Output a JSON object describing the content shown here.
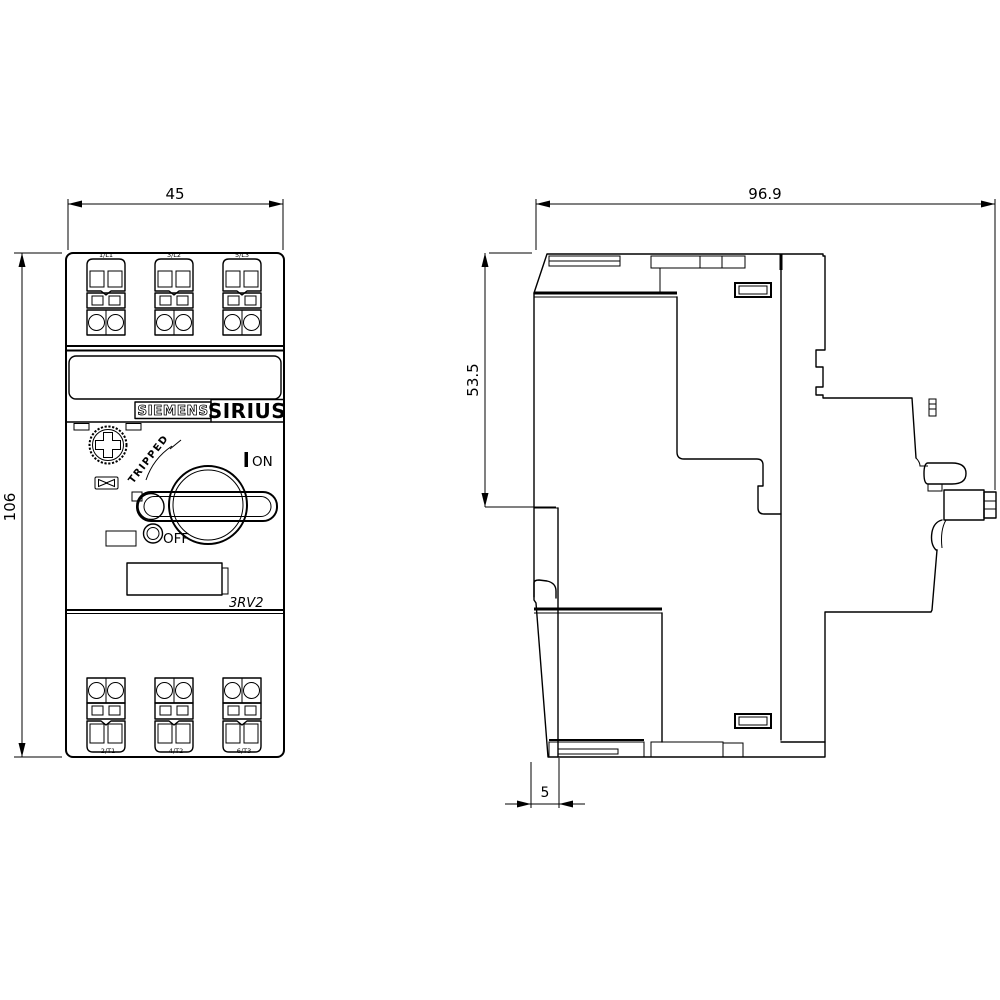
{
  "drawing": {
    "front": {
      "dim_width": "45",
      "dim_height": "106",
      "brand": "SIEMENS",
      "series": "SIRIUS",
      "model": "3RV2",
      "tripped_label": "TRIPPED",
      "on_label": "ON",
      "off_label": "OFF",
      "terminals_top": [
        "1/L1",
        "3/L2",
        "5/L3"
      ],
      "terminals_bottom": [
        "2/T1",
        "4/T2",
        "6/T3"
      ]
    },
    "side": {
      "dim_depth": "96.9",
      "dim_upper_height": "53.5",
      "dim_rail_offset": "5"
    },
    "colors": {
      "line": "#000000",
      "background": "#ffffff"
    }
  }
}
